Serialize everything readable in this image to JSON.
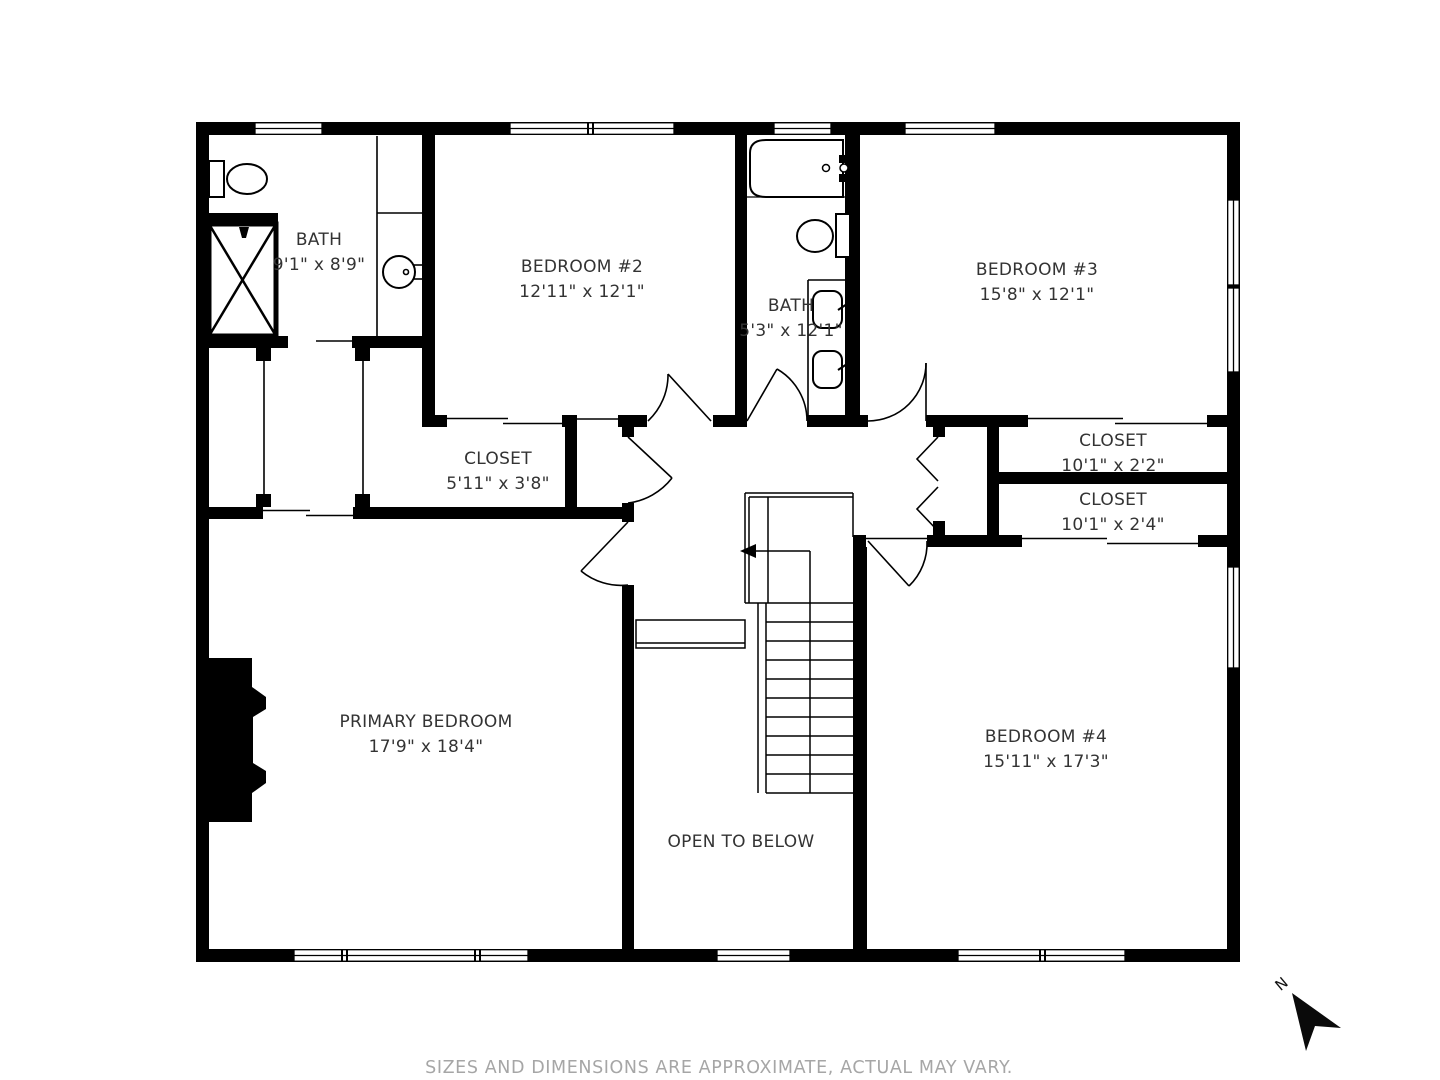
{
  "rooms": [
    {
      "name": "BATH",
      "dims": "9'1\" x 8'9\""
    },
    {
      "name": "BEDROOM #2",
      "dims": "12'11\" x 12'1\""
    },
    {
      "name": "BATH",
      "dims": "5'3\" x 12'1\""
    },
    {
      "name": "BEDROOM #3",
      "dims": "15'8\" x 12'1\""
    },
    {
      "name": "CLOSET",
      "dims": "5'11\" x 3'8\""
    },
    {
      "name": "CLOSET",
      "dims": "10'1\" x 2'2\""
    },
    {
      "name": "CLOSET",
      "dims": "10'1\" x 2'4\""
    },
    {
      "name": "PRIMARY BEDROOM",
      "dims": "17'9\" x 18'4\""
    },
    {
      "name": "BEDROOM #4",
      "dims": "15'11\" x 17'3\""
    }
  ],
  "annotations": {
    "open_to_below": "OPEN TO BELOW"
  },
  "compass": {
    "label": "N"
  },
  "footer": {
    "disclaimer": "SIZES AND DIMENSIONS ARE APPROXIMATE, ACTUAL MAY VARY."
  },
  "colors": {
    "wall": "#000000",
    "line": "#000000",
    "text": "#333333",
    "muted_text": "#a6a6a6",
    "background": "#ffffff"
  }
}
